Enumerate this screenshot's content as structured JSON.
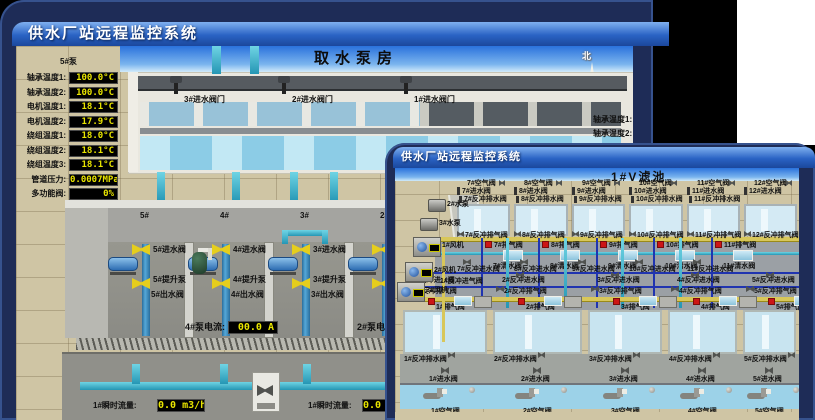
{
  "page": {
    "background": "#000000",
    "desktop_patch": "#ffffff"
  },
  "colors": {
    "window_frame": "#1e2c57",
    "titlebar_top": "#7fb0ef",
    "titlebar_bottom": "#1b479c",
    "scene_sand": "#cfc5a4",
    "sky": "#2a72dc",
    "led_text": "#e8e400",
    "led_bg": "#000000",
    "valve_yellow": "#e6ce1c",
    "valve_red": "#cc1616",
    "pipe_cyan": "#2fb0c6",
    "pipe_dark_blue": "#2034b0",
    "pipe_yellow": "#d8c75a",
    "water": "#9cd2e8"
  },
  "back_window": {
    "title": "供水厂站远程监控系统",
    "room_title": "取水泵房",
    "compass": {
      "north": "北",
      "west": "西",
      "south": "南",
      "east": "东"
    },
    "pump_panel": {
      "header": "5#泵",
      "rows": [
        {
          "label": "轴承温度1:",
          "value": "100.0°C"
        },
        {
          "label": "轴承温度2:",
          "value": "100.0°C"
        },
        {
          "label": "电机温度1:",
          "value": "18.1°C"
        },
        {
          "label": "电机温度2:",
          "value": "17.9°C"
        },
        {
          "label": "绕组温度1:",
          "value": "18.0°C"
        },
        {
          "label": "绕组温度2:",
          "value": "18.1°C"
        },
        {
          "label": "绕组温度3:",
          "value": "18.1°C"
        },
        {
          "label": "管道压力:",
          "value": "0.0007MPa"
        },
        {
          "label": "多功能阀:",
          "value": "0%"
        }
      ]
    },
    "intake_valves": [
      "3#进水阀门",
      "2#进水阀门",
      "1#进水阀门"
    ],
    "right_partial": {
      "header_fragment": "1",
      "labels": [
        "轴承温度1:",
        "轴承温度2:"
      ]
    },
    "pump_bays": [
      {
        "num": "5#",
        "inlet": "5#进水阀",
        "pump": "5#提升泵",
        "outlet": "5#出水阀"
      },
      {
        "num": "4#",
        "inlet": "4#进水阀",
        "pump": "4#提升泵",
        "outlet": "4#出水阀"
      },
      {
        "num": "3#",
        "inlet": "3#进水阀",
        "pump": "3#提升泵",
        "outlet": "3#出水阀"
      },
      {
        "num": "2#",
        "inlet": "",
        "pump": "",
        "outlet": ""
      }
    ],
    "current_meters": [
      {
        "label": "4#泵电流:",
        "value": "00.0 A"
      },
      {
        "label": "2#泵电流",
        "value": ""
      }
    ],
    "flow_meters": [
      {
        "label": "1#瞬时流量:",
        "value": "0.0 m3/h"
      },
      {
        "label": "1#瞬时流量:",
        "value": "0.0 m3/h"
      }
    ]
  },
  "front_window": {
    "title": "供水厂站远程监控系统",
    "pool_title": "1#V滤池",
    "top_air_valves": [
      "7#空气阀",
      "8#空气阀",
      "9#空气阀",
      "10#空气阀",
      "11#空气阀",
      "12#空气阀"
    ],
    "top_inlet_valves": [
      "7#进水阀",
      "8#进水阀",
      "9#进水阀",
      "10#进水阀",
      "11#进水阀",
      "12#进水阀"
    ],
    "top_backwash_drain_valves": [
      "7#反冲排水阀",
      "8#反冲排水阀",
      "9#反冲排水阀",
      "10#反冲排水阀",
      "11#反冲排水阀"
    ],
    "top_backwash_exhaust_valves": [
      "7#反冲排气阀",
      "8#反冲排气阀",
      "9#反冲排气阀",
      "10#反冲排气阀",
      "11#反冲排气阀",
      "12#反冲排气阀"
    ],
    "top_exhaust_valves": [
      "7#排气阀",
      "8#排气阀",
      "9#排气阀",
      "10#排气阀",
      "11#排气阀"
    ],
    "top_clean_water_valves": [
      "7#清水阀",
      "8#清水阀",
      "9#清水阀",
      "10#清水阀",
      "11#清水阀"
    ],
    "top_backwash_inlet_valves": [
      "7#反冲进水阀",
      "8#反冲进水阀",
      "9#反冲进水阀",
      "10#反冲进水阀",
      "11#反冲进水阀"
    ],
    "bottom_backwash_inlet_valves": [
      "1#反冲进水阀",
      "2#反冲进水阀",
      "3#反冲进水阀",
      "4#反冲进水阀",
      "5#反冲进水阀"
    ],
    "bottom_backwash_exhaust_valves": [
      "1#反冲排气阀",
      "2#反冲排气阀",
      "3#反冲排气阀",
      "4#反冲排气阀",
      "5#反冲排气阀"
    ],
    "bottom_exhaust_valves": [
      "1#排气阀",
      "2#排气阀",
      "3#排气阀",
      "4#排气阀",
      "5#排气阀"
    ],
    "bottom_backwash_drain_valves": [
      "1#反冲排水阀",
      "2#反冲排水阀",
      "3#反冲排水阀",
      "4#反冲排水阀",
      "5#反冲排水阀"
    ],
    "bottom_inlet_valves": [
      "1#进水阀",
      "2#进水阀",
      "3#进水阀",
      "4#进水阀",
      "5#进水阀"
    ],
    "bottom_air_valves": [
      "1#空气阀",
      "2#空气阀",
      "3#空气阀",
      "4#空气阀",
      "5#空气阀"
    ],
    "left_pumps": [
      "2#水泵",
      "3#水泵"
    ],
    "blowers": [
      "1#风机",
      "2#风机",
      "3#风机"
    ],
    "corridor_left_label": "1#反冲进气阀"
  }
}
